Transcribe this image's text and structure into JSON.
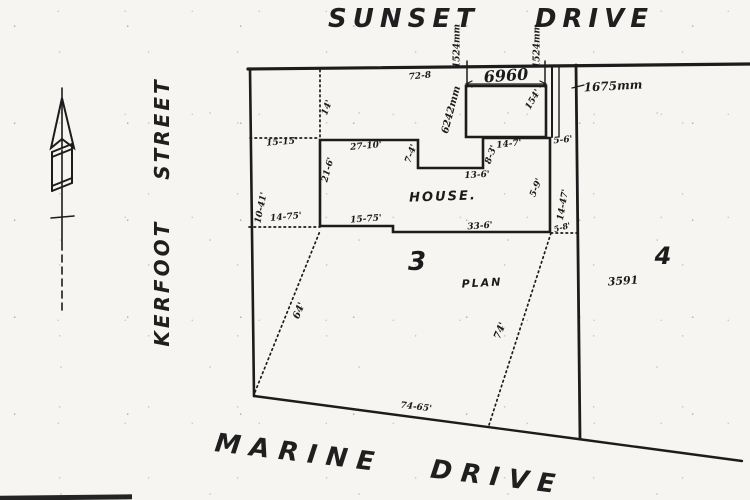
{
  "doc_type": "survey-plan-scan",
  "colors": {
    "ink": "#1c1c1c",
    "paper": "#f6f5f1"
  },
  "streets": {
    "top": {
      "word1": "SUNSET",
      "word2": "DRIVE"
    },
    "left": {
      "word1": "KERFOOT",
      "word2": "STREET"
    },
    "bottom": {
      "word1": "MARINE",
      "word2": "DRIVE"
    }
  },
  "lots": {
    "lot3": "3",
    "lot4": "4",
    "plan_label": "PLAN",
    "plan_number": "3591",
    "house_label": "HOUSE."
  },
  "compass": {
    "type": "north-arrow",
    "direction": "up"
  },
  "measurements": {
    "m1524_left": "1524mm",
    "m1524_right": "1524mm",
    "m6960": "6960",
    "m1675": "1675mm",
    "m728": "72-8",
    "m6242": "6242mm",
    "m154": "154'",
    "m14": "14'",
    "m1515": "15-15'",
    "m2710": "27-10'",
    "m74n": "7-4'",
    "m136": "13-6'",
    "m83": "8-3'",
    "m147": "14-7'",
    "m56": "5-6'",
    "m216": "21-6'",
    "m1041": "10-41'",
    "m1475": "14-75'",
    "m1575": "15-75'",
    "m336": "33-6'",
    "m59": "5-9'",
    "m1447": "14-47'",
    "m58": "5-8'",
    "m64": "64'",
    "m74": "74'",
    "m7465": "74-65'"
  }
}
